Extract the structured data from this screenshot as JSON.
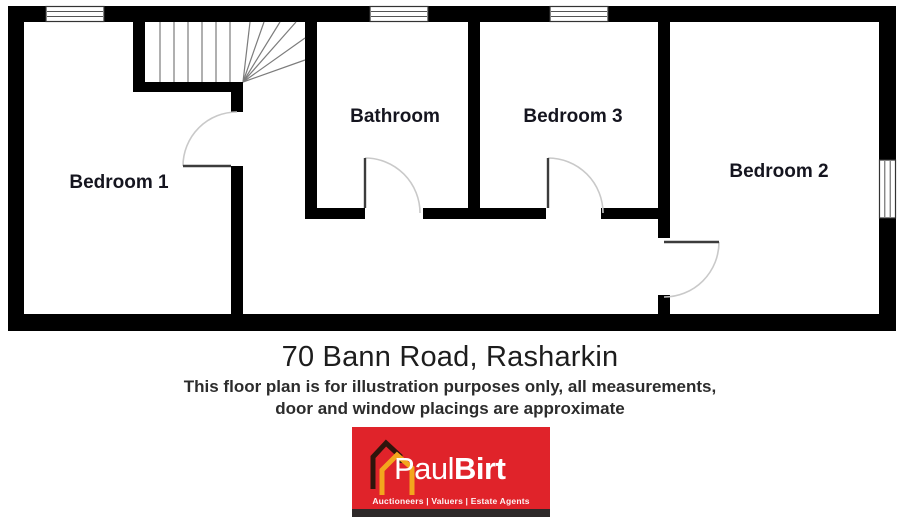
{
  "floorplan": {
    "rooms": [
      {
        "name": "Bedroom 1"
      },
      {
        "name": "Bathroom"
      },
      {
        "name": "Bedroom 3"
      },
      {
        "name": "Bedroom 2"
      }
    ],
    "features": [
      "staircase",
      "3 top windows",
      "1 right window",
      "4 door swings"
    ],
    "wall_color": "#000000"
  },
  "caption": {
    "title": "70 Bann Road, Rasharkin",
    "disclaimer_line1": "This floor plan is for illustration purposes only, all measurements,",
    "disclaimer_line2": "door and window placings are approximate"
  },
  "logo": {
    "name_first": "Paul",
    "name_last": "Birt",
    "tagline": "Auctioneers | Valuers | Estate Agents",
    "colors": {
      "background": "#e0232a",
      "bottom_bar": "#2e2929",
      "house_back_outline": "#2f150c",
      "house_front_outline": "#f3a61d",
      "text": "#ffffff"
    }
  }
}
